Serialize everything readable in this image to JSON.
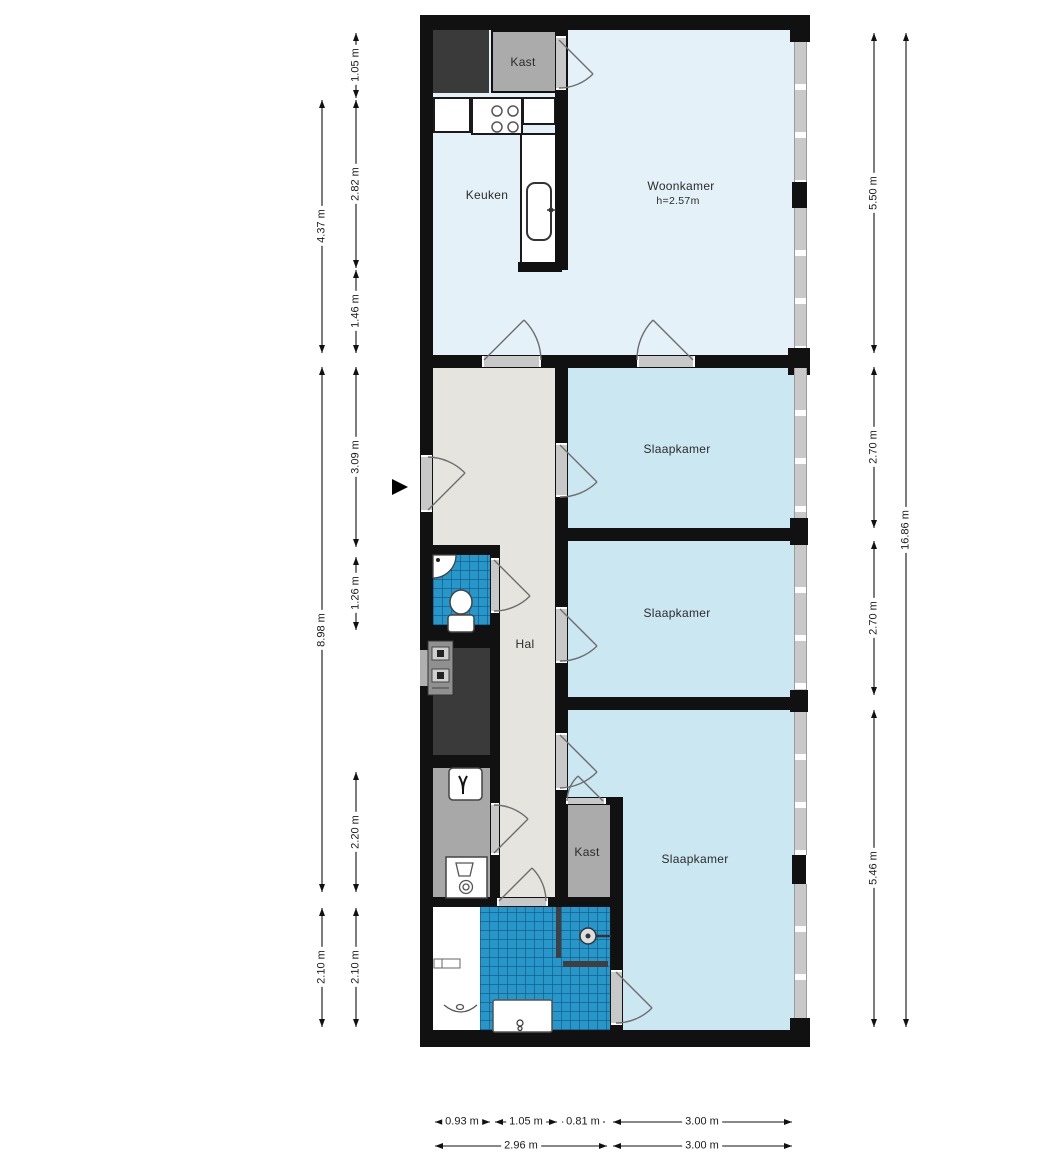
{
  "plan": {
    "rooms": {
      "woonkamer": {
        "label": "Woonkamer",
        "ceiling_height": "h=2.57m"
      },
      "keuken": {
        "label": "Keuken"
      },
      "hal": {
        "label": "Hal"
      },
      "slaapkamer_1": {
        "label": "Slaapkamer"
      },
      "slaapkamer_2": {
        "label": "Slaapkamer"
      },
      "slaapkamer_3": {
        "label": "Slaapkamer"
      },
      "kast_boven": {
        "label": "Kast"
      },
      "kast_onder": {
        "label": "Kast"
      }
    },
    "dimensions": {
      "left_outer": [
        {
          "label": "4.37 m"
        },
        {
          "label": "8.98 m"
        },
        {
          "label": "2.10 m"
        }
      ],
      "left_inner": [
        {
          "label": "1.05 m"
        },
        {
          "label": "2.82 m"
        },
        {
          "label": "1.46 m"
        },
        {
          "label": "3.09 m"
        },
        {
          "label": "1.26 m"
        },
        {
          "label": "2.20 m"
        },
        {
          "label": "2.10 m"
        }
      ],
      "right_inner": [
        {
          "label": "5.50 m"
        },
        {
          "label": "2.70 m"
        },
        {
          "label": "2.70 m"
        },
        {
          "label": "5.46 m"
        }
      ],
      "right_outer": [
        {
          "label": "16.86 m"
        }
      ],
      "bottom_upper": [
        {
          "label": "0.93 m"
        },
        {
          "label": "1.05 m"
        },
        {
          "label": "0.81 m"
        },
        {
          "label": "3.00 m"
        }
      ],
      "bottom_lower": [
        {
          "label": "2.96 m"
        },
        {
          "label": "3.00 m"
        }
      ]
    },
    "colors": {
      "wall": "#111111",
      "living_floor": "#e4f1f8",
      "bedroom_floor": "#cbe7f2",
      "hall_floor": "#e6e4de",
      "closet_gray": "#ababab",
      "shaft_dark": "#3a3a3a",
      "bathroom_tiles": "#2796c9",
      "window_frame": "#c9c9c9"
    }
  }
}
